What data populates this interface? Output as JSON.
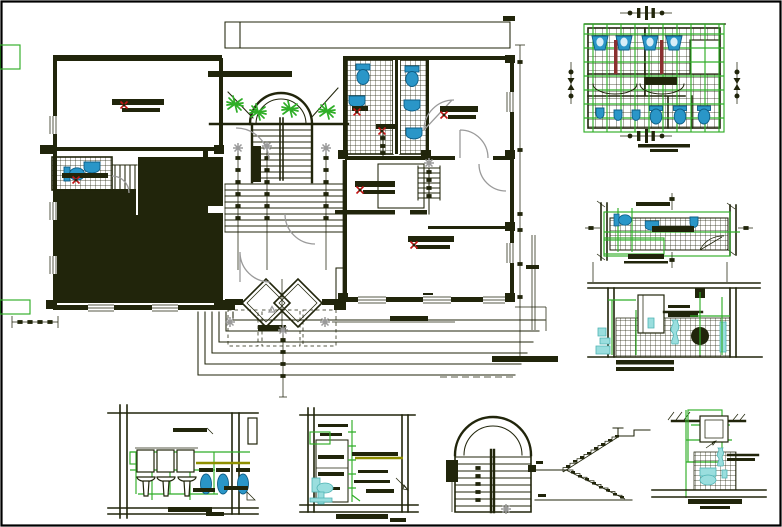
{
  "document": {
    "kind": "architectural CAD drawing sheet",
    "description": "House floor plan with sanitary and staircase detail drawings",
    "background": "#ffffff",
    "sheet_border_color": "#000000"
  },
  "palette": {
    "ink": "#21250b",
    "setting_out_green": "#2fae27",
    "fixture_blue": "#2a96c8",
    "fixture_blue_dark": "#0d5d85",
    "fixture_cyan": "#9adede",
    "marker_red": "#c41414",
    "dim_gray": "#9a9a9a",
    "highlight_olive": "#8f8f00",
    "pipe_brown": "#8a3030"
  },
  "panels": [
    {
      "id": "main-floor-plan",
      "type": "floor-plan",
      "features": [
        "central arched staircase with wide spreading steps",
        "two solid-filled (hatched) rooms",
        "tiled bathroom with WC and basin (left)",
        "two tiled bathrooms with WCs (top centre)",
        "entry hall with rug outline",
        "secondary flight of steps",
        "entry porch with double-diamond door and nested threshold step lines",
        "planter with plants along arch",
        "door swing arcs",
        "dimension tick chains",
        "window breaks in walls"
      ]
    },
    {
      "id": "toilet-block-plan-detail",
      "type": "detail-plan",
      "features": [
        "green setting-out tile grid",
        "four wash basins",
        "three urinals",
        "three WCs",
        "dimension marker clusters top/bottom/left/right",
        "title bar"
      ]
    },
    {
      "id": "narrow-bathroom-plan-detail",
      "type": "detail-plan",
      "features": [
        "tile grid band",
        "WC",
        "wash basin",
        "green setting-out lines",
        "dimension markers",
        "title bar"
      ]
    },
    {
      "id": "bathroom-section-detail",
      "type": "interior-elevation",
      "features": [
        "mirror cabinet",
        "wash basin",
        "tiled dado",
        "cyan plumbing fixtures",
        "green dimension lines",
        "title bars"
      ]
    },
    {
      "id": "bathroom-elevation-detail",
      "type": "interior-elevation",
      "features": [
        "three mirrors",
        "three pedestal wash basins",
        "three WCs",
        "green piping lines",
        "olive counter line",
        "title bar"
      ]
    },
    {
      "id": "closet-elevation-detail",
      "type": "interior-elevation",
      "features": [
        "shelved closet",
        "green datum line with ticks",
        "olive shelf line",
        "cyan WC side view",
        "leader arrow",
        "title bar"
      ]
    },
    {
      "id": "stair-plan-detail",
      "type": "detail-plan",
      "features": [
        "semicircular arched end",
        "central double stringer",
        "treads",
        "tick beads",
        "gray reference marker"
      ]
    },
    {
      "id": "stair-section-detail",
      "type": "section",
      "features": [
        "two flights dog-leg stair",
        "tread blocks",
        "landings"
      ]
    },
    {
      "id": "toilet-elevation-detail",
      "type": "interior-elevation",
      "features": [
        "cistern box",
        "green setting-out frame",
        "tiled dado",
        "cyan WC",
        "ground line",
        "title bar"
      ]
    }
  ],
  "annotations": {
    "legible_text": false,
    "note": "All textual labels in the source render as solid ink bars at this scale; no characters are legible, so labels are reproduced as bars.",
    "label_bar_count": 24,
    "red_cross_marker_count": 7,
    "gray_reference_marker_count": 9,
    "window_break_count": 10
  }
}
